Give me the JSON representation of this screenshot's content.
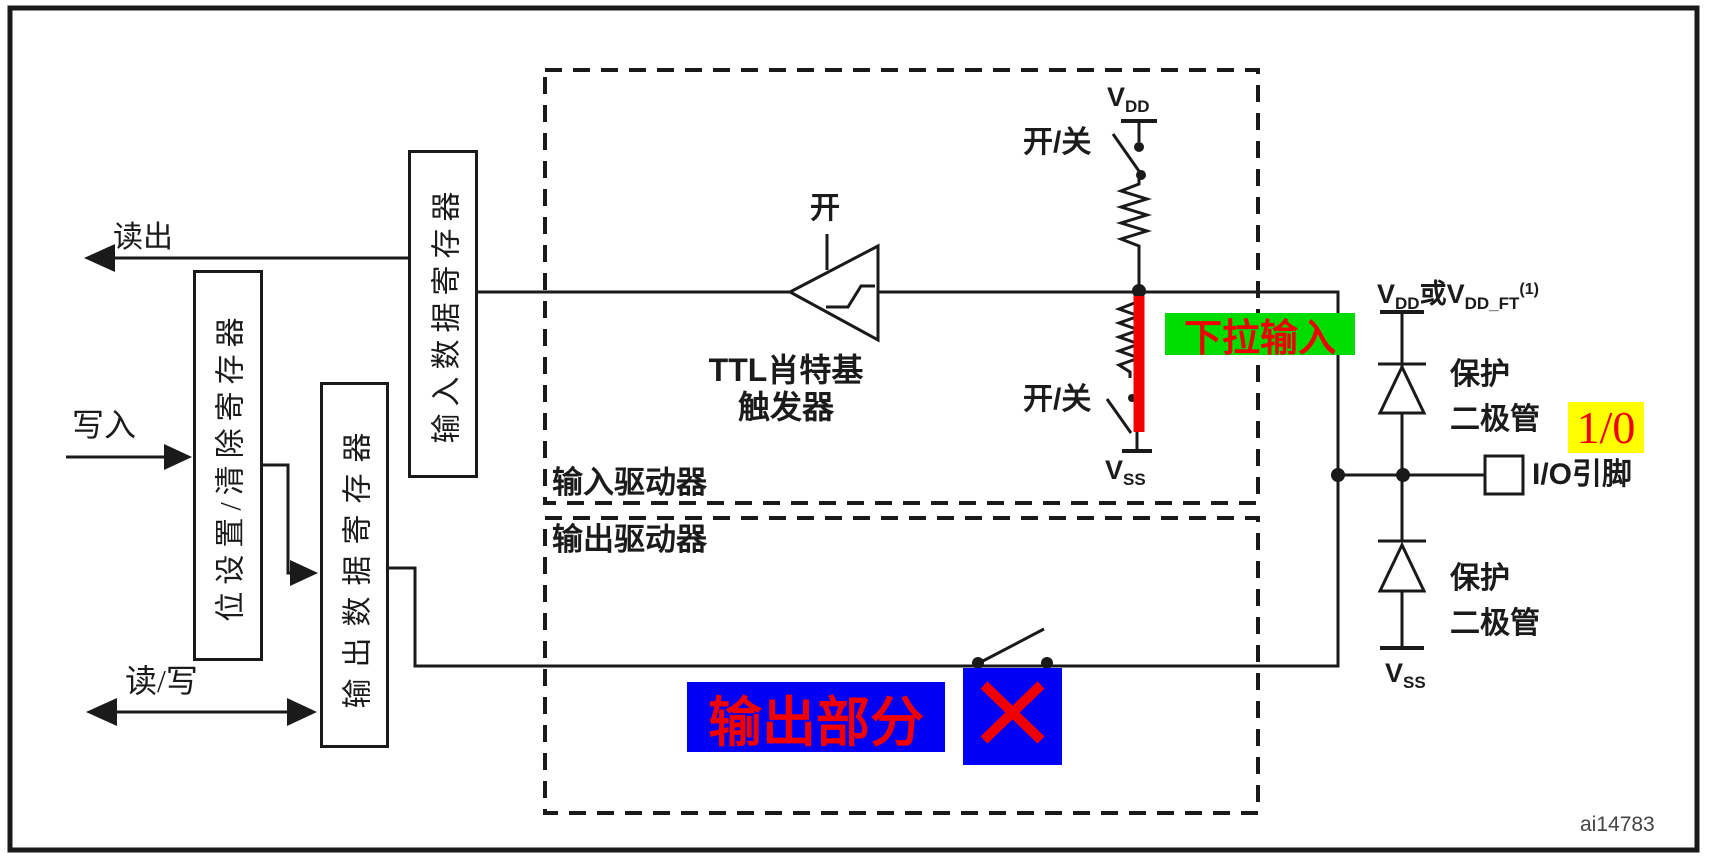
{
  "figure_id": "ai14783",
  "bus_labels": {
    "read_out": "读出",
    "write": "写入",
    "read_write": "读/写"
  },
  "registers": {
    "input_data": "输入数据寄存器",
    "bit_set_clear": "位设置/清除寄存器",
    "output_data": "输出数据寄存器"
  },
  "drivers": {
    "input": "输入驱动器",
    "output": "输出驱动器"
  },
  "schmitt": {
    "on": "开",
    "name_line1": "TTL肖特基",
    "name_line2": "触发器"
  },
  "pull_network": {
    "vdd_main": "V",
    "vdd_sub": "DD",
    "on_off_top": "开/关",
    "on_off_bottom": "开/关",
    "vss_main": "V",
    "vss_sub": "SS"
  },
  "pin_section": {
    "vdd_or": {
      "v1": "V",
      "s1": "DD",
      "or": "或",
      "v2": "V",
      "s2": "DD_FT",
      "sup": "(1)"
    },
    "protection_top_line1": "保护",
    "protection_top_line2": "二极管",
    "protection_bottom_line1": "保护",
    "protection_bottom_line2": "二极管",
    "io_pin": "I/O引脚",
    "vss_main": "V",
    "vss_sub": "SS"
  },
  "annotations": {
    "pull_down_input": "下拉输入",
    "one_zero": "1/0",
    "output_section": "输出部分",
    "x_mark": "✕"
  },
  "colors": {
    "line": "#1a1a1a",
    "red": "#f00000",
    "green_bg": "#00dc00",
    "yellow_bg": "#ffff00",
    "blue_bg": "#0000f5"
  }
}
